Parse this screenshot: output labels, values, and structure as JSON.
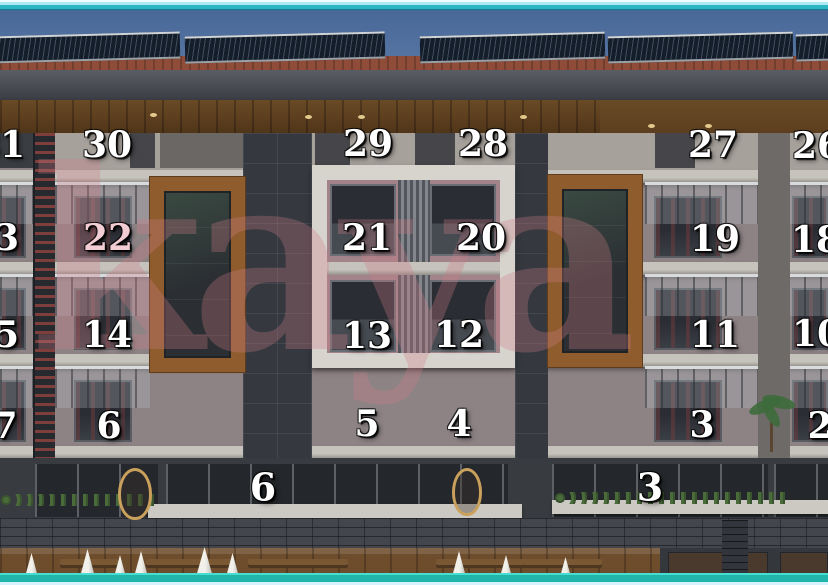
{
  "watermark": {
    "text": "kaya",
    "color": "#cf7d88",
    "opacity": 0.3
  },
  "palette": {
    "frame_teal_top": "#2cb6c4",
    "frame_teal_bottom": "#1fb5aa",
    "sky_blue": "#5c7aa7",
    "facade_pink": "#b28a8e",
    "wood_brown": "#8f5c2e",
    "number_white": "#ffffff",
    "number_tinted": "#f2cdd3"
  },
  "unit_labels": [
    {
      "id": "f4-31",
      "label": "31",
      "x": 0,
      "y": 145
    },
    {
      "id": "f4-30",
      "label": "30",
      "x": 107,
      "y": 145
    },
    {
      "id": "f4-29",
      "label": "29",
      "x": 368,
      "y": 144
    },
    {
      "id": "f4-28",
      "label": "28",
      "x": 483,
      "y": 144
    },
    {
      "id": "f4-27",
      "label": "27",
      "x": 713,
      "y": 145
    },
    {
      "id": "f4-26",
      "label": "26",
      "x": 817,
      "y": 146
    },
    {
      "id": "f3-23",
      "label": "23",
      "x": -6,
      "y": 238
    },
    {
      "id": "f3-22",
      "label": "22",
      "x": 108,
      "y": 238,
      "color": "#f2cdd3"
    },
    {
      "id": "f3-21",
      "label": "21",
      "x": 367,
      "y": 238
    },
    {
      "id": "f3-20",
      "label": "20",
      "x": 481,
      "y": 238
    },
    {
      "id": "f3-19",
      "label": "19",
      "x": 715,
      "y": 239
    },
    {
      "id": "f3-18",
      "label": "18",
      "x": 816,
      "y": 240
    },
    {
      "id": "f2-15",
      "label": "15",
      "x": -6,
      "y": 335
    },
    {
      "id": "f2-14",
      "label": "14",
      "x": 107,
      "y": 335
    },
    {
      "id": "f2-13",
      "label": "13",
      "x": 367,
      "y": 336
    },
    {
      "id": "f2-12",
      "label": "12",
      "x": 459,
      "y": 335
    },
    {
      "id": "f2-11",
      "label": "11",
      "x": 715,
      "y": 335
    },
    {
      "id": "f2-10",
      "label": "10",
      "x": 817,
      "y": 334
    },
    {
      "id": "f1-7",
      "label": "7",
      "x": 5,
      "y": 426
    },
    {
      "id": "f1-6",
      "label": "6",
      "x": 109,
      "y": 426
    },
    {
      "id": "f1-5",
      "label": "5",
      "x": 367,
      "y": 424
    },
    {
      "id": "f1-4",
      "label": "4",
      "x": 459,
      "y": 424
    },
    {
      "id": "f1-3",
      "label": "3",
      "x": 702,
      "y": 425
    },
    {
      "id": "f1-2",
      "label": "2",
      "x": 820,
      "y": 426
    },
    {
      "id": "g-6",
      "label": "6",
      "x": 263,
      "y": 487,
      "size": 38
    },
    {
      "id": "g-3",
      "label": "3",
      "x": 650,
      "y": 487,
      "size": 38
    }
  ]
}
